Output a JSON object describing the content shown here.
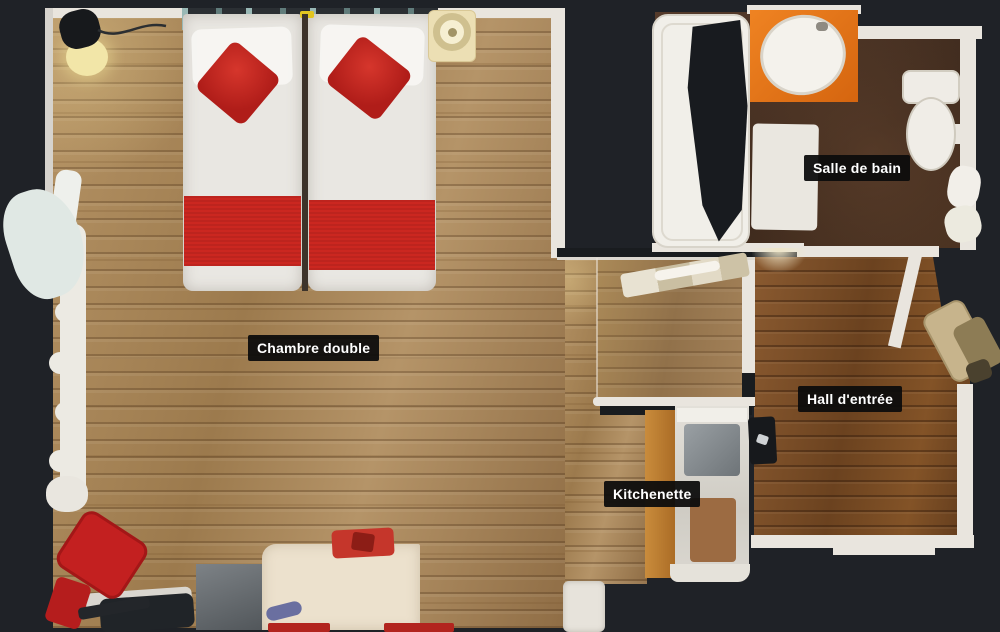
{
  "rooms": [
    {
      "id": "bedroom",
      "label": "Chambre double"
    },
    {
      "id": "bathroom",
      "label": "Salle de bain"
    },
    {
      "id": "hall",
      "label": "Hall d'entrée"
    },
    {
      "id": "kitchenette",
      "label": "Kitchenette"
    }
  ],
  "colors": {
    "background": "#1f2227",
    "label_background": "#0c0c0c",
    "label_text": "#ffffff",
    "wall": "#e9e5de",
    "wood_bedroom": "#a5845a",
    "wood_hall": "#7a4c26",
    "bathroom_floor": "#46301f",
    "bed_red": "#cb2720",
    "counter_orange": "#e2731c",
    "chair_red": "#c32020"
  }
}
